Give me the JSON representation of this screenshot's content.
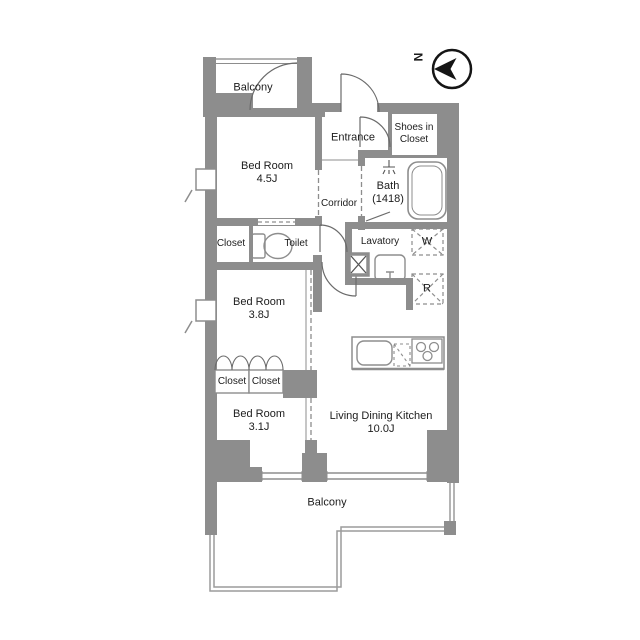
{
  "compass": {
    "north_label": "N"
  },
  "rooms": {
    "balcony_north": {
      "label": "Balcony"
    },
    "bedroom_45": {
      "name": "Bed Room",
      "size": "4.5J"
    },
    "entrance": {
      "label": "Entrance"
    },
    "shoes_in_closet": {
      "line1": "Shoes in",
      "line2": "Closet"
    },
    "bath": {
      "name": "Bath",
      "size": "(1418)"
    },
    "corridor": {
      "label": "Corridor"
    },
    "closet_north": {
      "label": "Closet"
    },
    "toilet": {
      "label": "Toilet"
    },
    "lavatory": {
      "label": "Lavatory"
    },
    "washer_space": {
      "label": "W"
    },
    "refrigerator_space": {
      "label": "R"
    },
    "bedroom_38": {
      "name": "Bed Room",
      "size": "3.8J"
    },
    "closet_west": {
      "label": "Closet"
    },
    "closet_east": {
      "label": "Closet"
    },
    "bedroom_31": {
      "name": "Bed Room",
      "size": "3.1J"
    },
    "ldk": {
      "name": "Living Dining Kitchen",
      "size": "10.0J"
    },
    "balcony_south": {
      "label": "Balcony"
    }
  },
  "colors": {
    "wall": "#8d8d8d",
    "line": "#8d8d8d",
    "light_line": "#b3b3b3",
    "text": "#1c1c1c"
  }
}
